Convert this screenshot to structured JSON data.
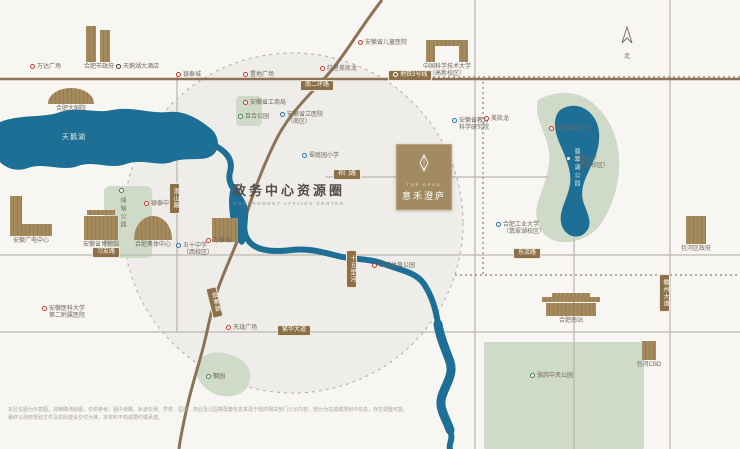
{
  "title_block": {
    "title": "政务中心资源圈",
    "subtitle": "GOVERNMENT AFFAIRS CENTER"
  },
  "project": {
    "name_en": "TOP OPUS",
    "name_cn": "意禾澄庐"
  },
  "compass": {
    "label": "北"
  },
  "water_labels": [
    {
      "x": 62,
      "y": 132,
      "text": "天鹅湖",
      "vertical": false
    },
    {
      "x": 572,
      "y": 148,
      "text": "翡翠湖公园",
      "vertical": true
    }
  ],
  "pois": [
    {
      "x": 30,
      "y": 64,
      "dot": "red",
      "lines": [
        "万达广场"
      ]
    },
    {
      "x": 116,
      "y": 64,
      "dot": "dark",
      "lines": [
        "天鹅湖大酒店"
      ]
    },
    {
      "x": 176,
      "y": 72,
      "dot": "red",
      "lines": [
        "银泰城"
      ]
    },
    {
      "x": 243,
      "y": 72,
      "dot": "red",
      "lines": [
        "置地广场"
      ]
    },
    {
      "x": 320,
      "y": 66,
      "dot": "red",
      "lines": [
        "红星美凯龙"
      ]
    },
    {
      "x": 358,
      "y": 40,
      "dot": "red",
      "lines": [
        "安徽省儿童医院"
      ]
    },
    {
      "x": 243,
      "y": 100,
      "dot": "red",
      "lines": [
        "安徽省工商局"
      ]
    },
    {
      "x": 280,
      "y": 112,
      "dot": "blue",
      "lines": [
        "安徽省立医院",
        "（南区）"
      ]
    },
    {
      "x": 238,
      "y": 114,
      "dot": "green",
      "lines": [
        "百合公园"
      ]
    },
    {
      "x": 302,
      "y": 153,
      "dot": "blue",
      "lines": [
        "翠庭园小学"
      ]
    },
    {
      "x": 452,
      "y": 118,
      "dot": "blue",
      "lines": [
        "安徽省教育",
        "科学研究院"
      ]
    },
    {
      "x": 484,
      "y": 116,
      "dot": "red",
      "lines": [
        "美凯龙"
      ]
    },
    {
      "x": 549,
      "y": 126,
      "dot": "red",
      "lines": [
        "加侨国际广场"
      ]
    },
    {
      "x": 566,
      "y": 156,
      "dot": "blue",
      "lines": [
        "西园小学",
        "（翡翠校区）"
      ]
    },
    {
      "x": 496,
      "y": 222,
      "dot": "blue",
      "lines": [
        "合肥工业大学",
        "（翡翠湖校区）"
      ]
    },
    {
      "x": 144,
      "y": 201,
      "dot": "red",
      "lines": [
        "银泰中心"
      ]
    },
    {
      "x": 206,
      "y": 238,
      "dot": "red",
      "lines": [
        "万象城"
      ]
    },
    {
      "x": 176,
      "y": 243,
      "dot": "blue",
      "lines": [
        "五十中学",
        "（西校区）"
      ]
    },
    {
      "x": 42,
      "y": 306,
      "dot": "red",
      "lines": [
        "安徽医科大学",
        "第二附属医院"
      ]
    },
    {
      "x": 226,
      "y": 325,
      "dot": "red",
      "lines": [
        "天珑广场"
      ]
    },
    {
      "x": 372,
      "y": 263,
      "dot": "red",
      "lines": [
        "匡河体育公园"
      ]
    },
    {
      "x": 530,
      "y": 373,
      "dot": "green",
      "lines": [
        "骆岗中央公园"
      ]
    },
    {
      "x": 206,
      "y": 374,
      "dot": "green",
      "lines": [
        "徽园"
      ]
    },
    {
      "x": 118,
      "y": 188,
      "dot": "green",
      "lines": [
        "绿轴公园"
      ],
      "vertical": true
    }
  ],
  "buildings": [
    {
      "x": 84,
      "y": 26,
      "w": 30,
      "h": 36,
      "shape": "twin",
      "lines": [
        "合肥市政府"
      ]
    },
    {
      "x": 48,
      "y": 88,
      "w": 46,
      "h": 16,
      "shape": "shell",
      "lines": [
        "合肥大剧院"
      ]
    },
    {
      "x": 84,
      "y": 210,
      "w": 34,
      "h": 30,
      "shape": "museum",
      "lines": [
        "安徽省博物馆"
      ]
    },
    {
      "x": 134,
      "y": 216,
      "w": 38,
      "h": 24,
      "shape": "dome",
      "lines": [
        "合肥奥体中心"
      ]
    },
    {
      "x": 212,
      "y": 218,
      "w": 26,
      "h": 24,
      "shape": "box",
      "lines": []
    },
    {
      "x": 426,
      "y": 40,
      "w": 42,
      "h": 22,
      "shape": "gate",
      "lines": [
        "中国科学技术大学",
        "（高新校区）"
      ]
    },
    {
      "x": 10,
      "y": 196,
      "w": 42,
      "h": 40,
      "shape": "ltower",
      "lines": [
        "安徽广电中心"
      ]
    },
    {
      "x": 542,
      "y": 293,
      "w": 58,
      "h": 23,
      "shape": "station",
      "lines": [
        "合肥南站"
      ]
    },
    {
      "x": 642,
      "y": 341,
      "w": 14,
      "h": 19,
      "shape": "box",
      "lines": [
        "包河CBD"
      ]
    },
    {
      "x": 686,
      "y": 216,
      "w": 20,
      "h": 28,
      "shape": "box",
      "lines": [
        "包河区政府"
      ]
    }
  ],
  "road_labels": [
    {
      "x": 300,
      "y": 80,
      "text": "南二环路"
    },
    {
      "x": 388,
      "y": 70,
      "text": "地铁3号线",
      "metro": true
    },
    {
      "x": 333,
      "y": 169,
      "text": "祁门路"
    },
    {
      "x": 92,
      "y": 247,
      "text": "习友路"
    },
    {
      "x": 513,
      "y": 248,
      "text": "东流路"
    },
    {
      "x": 277,
      "y": 325,
      "text": "繁华大道"
    },
    {
      "x": 169,
      "y": 183,
      "text": "潜山路",
      "vertical": true
    },
    {
      "x": 346,
      "y": 250,
      "text": "十五里河",
      "vertical": true
    },
    {
      "x": 209,
      "y": 287,
      "text": "金寨路",
      "vertical": true,
      "rotate": -14
    },
    {
      "x": 659,
      "y": 274,
      "text": "徽州大道",
      "vertical": true
    }
  ],
  "disclaimer": {
    "line1": "本区位图为示意图，非精确测绘图，仅供参考；图中道路、轨道交通、学校、医院、商业及公园等配套信息来源于政府相关部门公示内容，部分为在建或规划中信息，存在调整可能，",
    "line2": "最终以政府规划文件及实际建设交付为准，本资料不构成要约或承诺。"
  },
  "colors": {
    "water": "#1d6f96",
    "park": "#cfdac9",
    "road_major": "#8d7355",
    "pill": "#8c7148",
    "accent": "#a28a63",
    "red": "#c03a2b",
    "blue": "#2471a3",
    "green": "#43803e"
  }
}
